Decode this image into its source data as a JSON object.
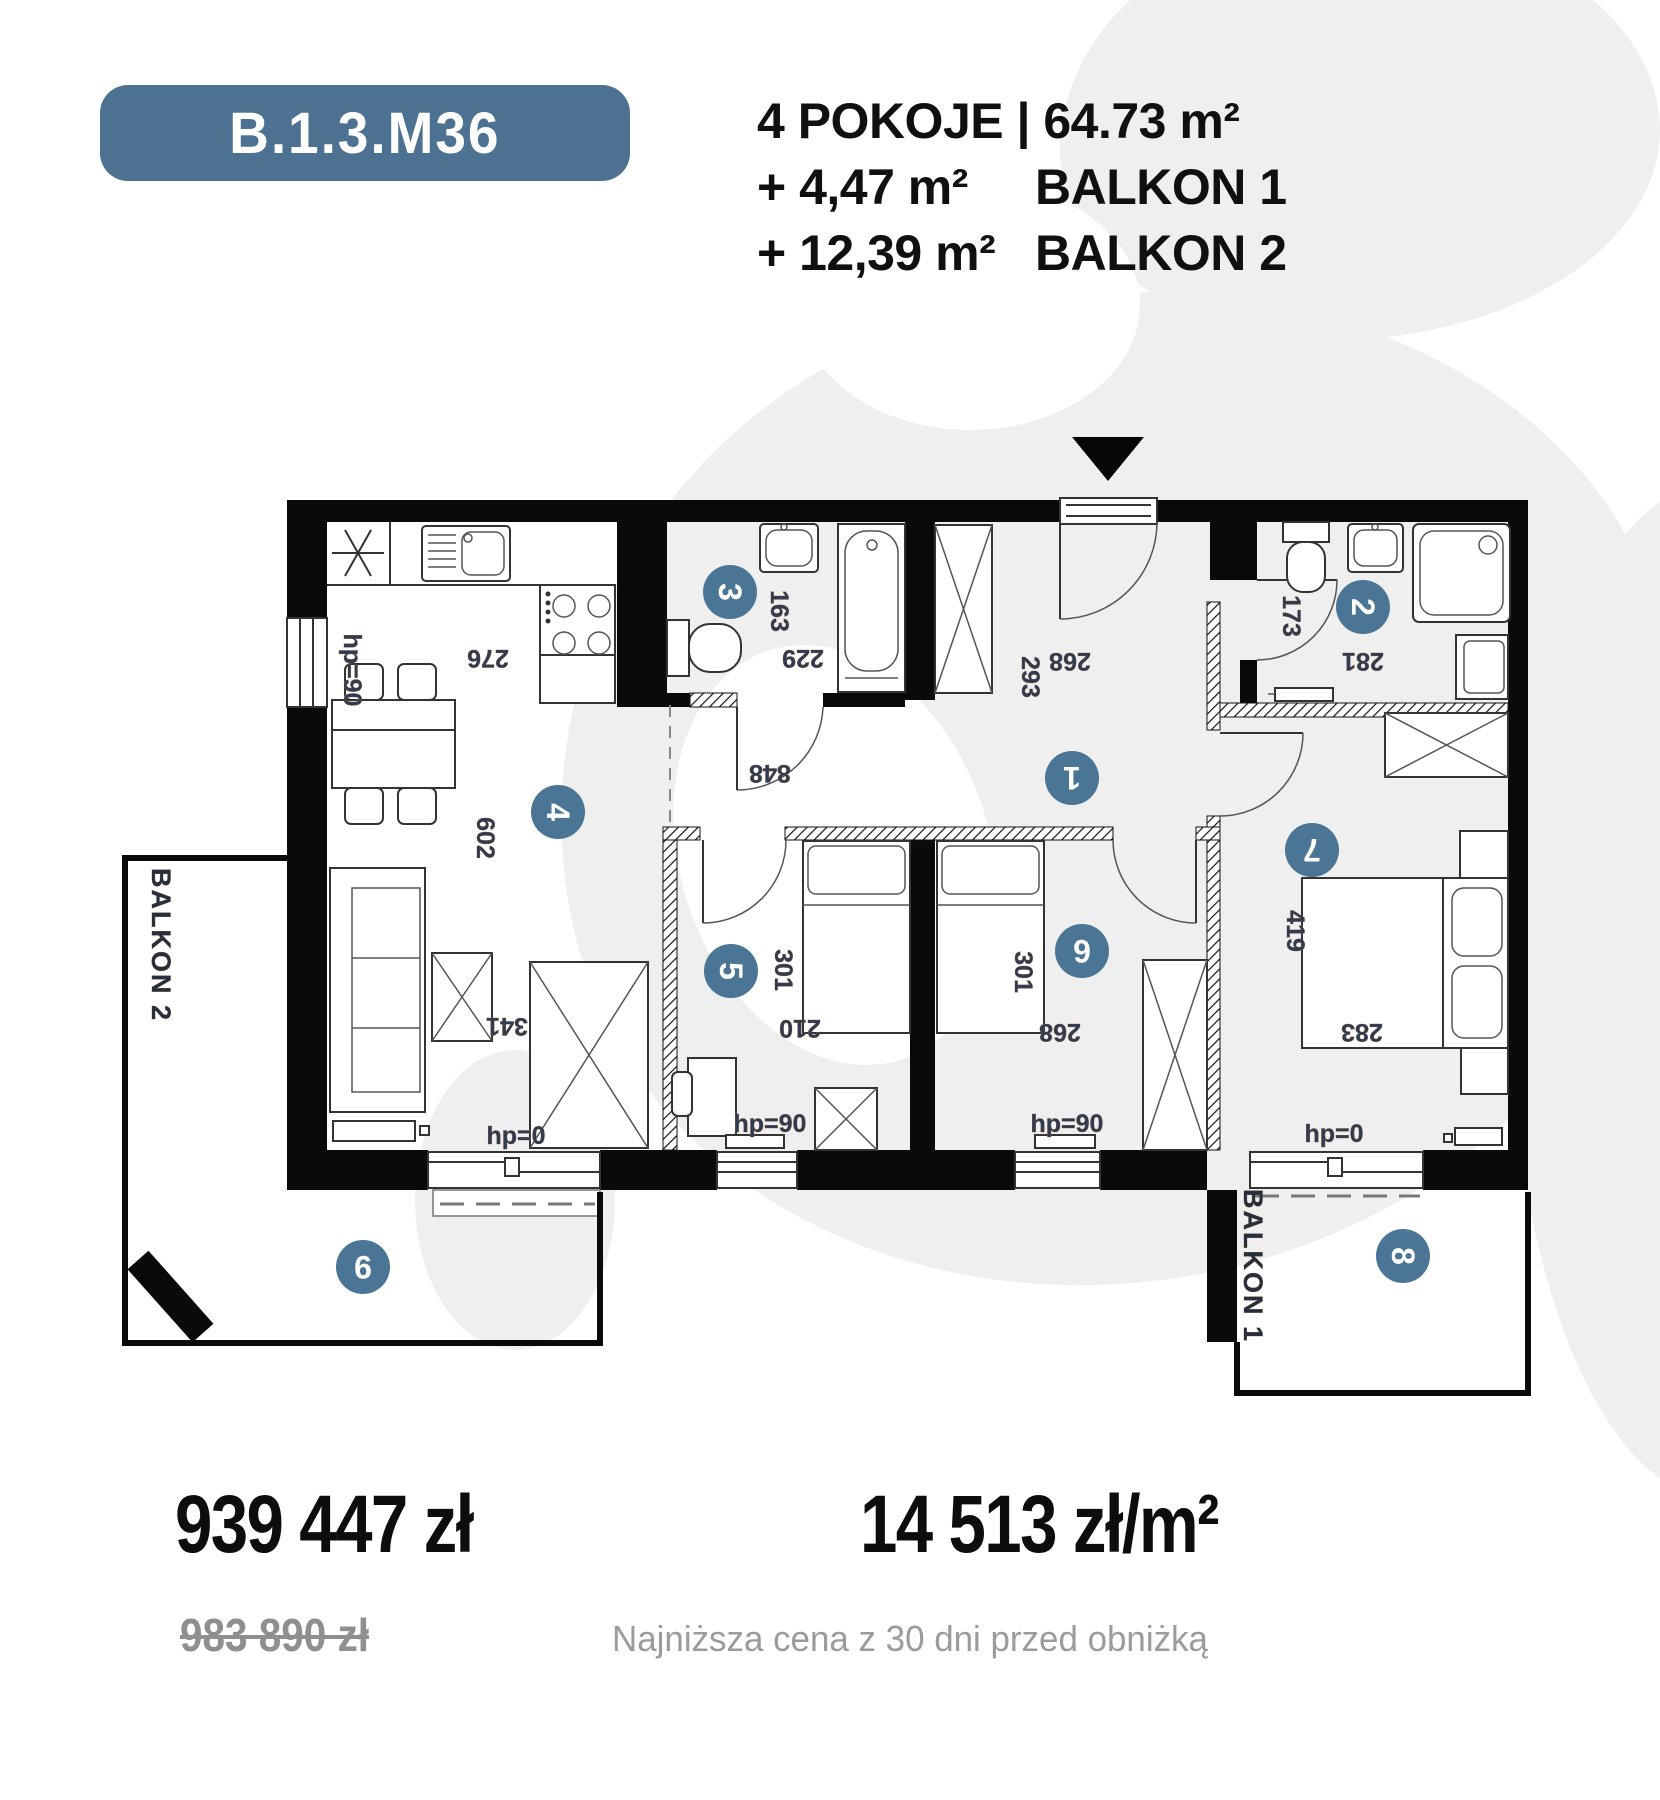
{
  "badge": {
    "unit_id": "B.1.3.M36"
  },
  "header": {
    "line1": "4 POKOJE | 64.73 m²",
    "line2_value": "+ 4,47 m²",
    "line2_label": "BALKON 1",
    "line3_value": "+ 12,39 m²",
    "line3_label": "BALKON 2"
  },
  "pricing": {
    "price": "939 447 zł",
    "price_per_m2": "14 513 zł/m²",
    "old_price": "983 890 zł",
    "note": "Najniższa cena z 30 dni przed obniżką"
  },
  "plan": {
    "room_numbers": [
      "1",
      "2",
      "3",
      "4",
      "5",
      "6",
      "7",
      "8",
      "9"
    ],
    "balkon1_label": "BALKON 1",
    "balkon2_label": "BALKON 2",
    "dims": {
      "kitchen_width": "276",
      "living_length": "602",
      "living_width": "341",
      "bath3_height": "163",
      "bath3_width": "229",
      "hall_length": "848",
      "hall_height": "293",
      "hall_width": "268",
      "bath2_height": "173",
      "bath2_width": "281",
      "room5_length": "301",
      "room5_width": "210",
      "room6_length": "301",
      "room6_width": "268",
      "room7_length": "419",
      "room7_width": "283"
    },
    "hp_labels": {
      "living_side": "hp=90",
      "living_door": "hp=0",
      "room5": "hp=90",
      "room6": "hp=90",
      "room7": "hp=0"
    }
  },
  "colors": {
    "accent": "#4d7191",
    "circle": "#4a7595",
    "watermark": "#efefef",
    "dim_text": "#2f3c52"
  }
}
